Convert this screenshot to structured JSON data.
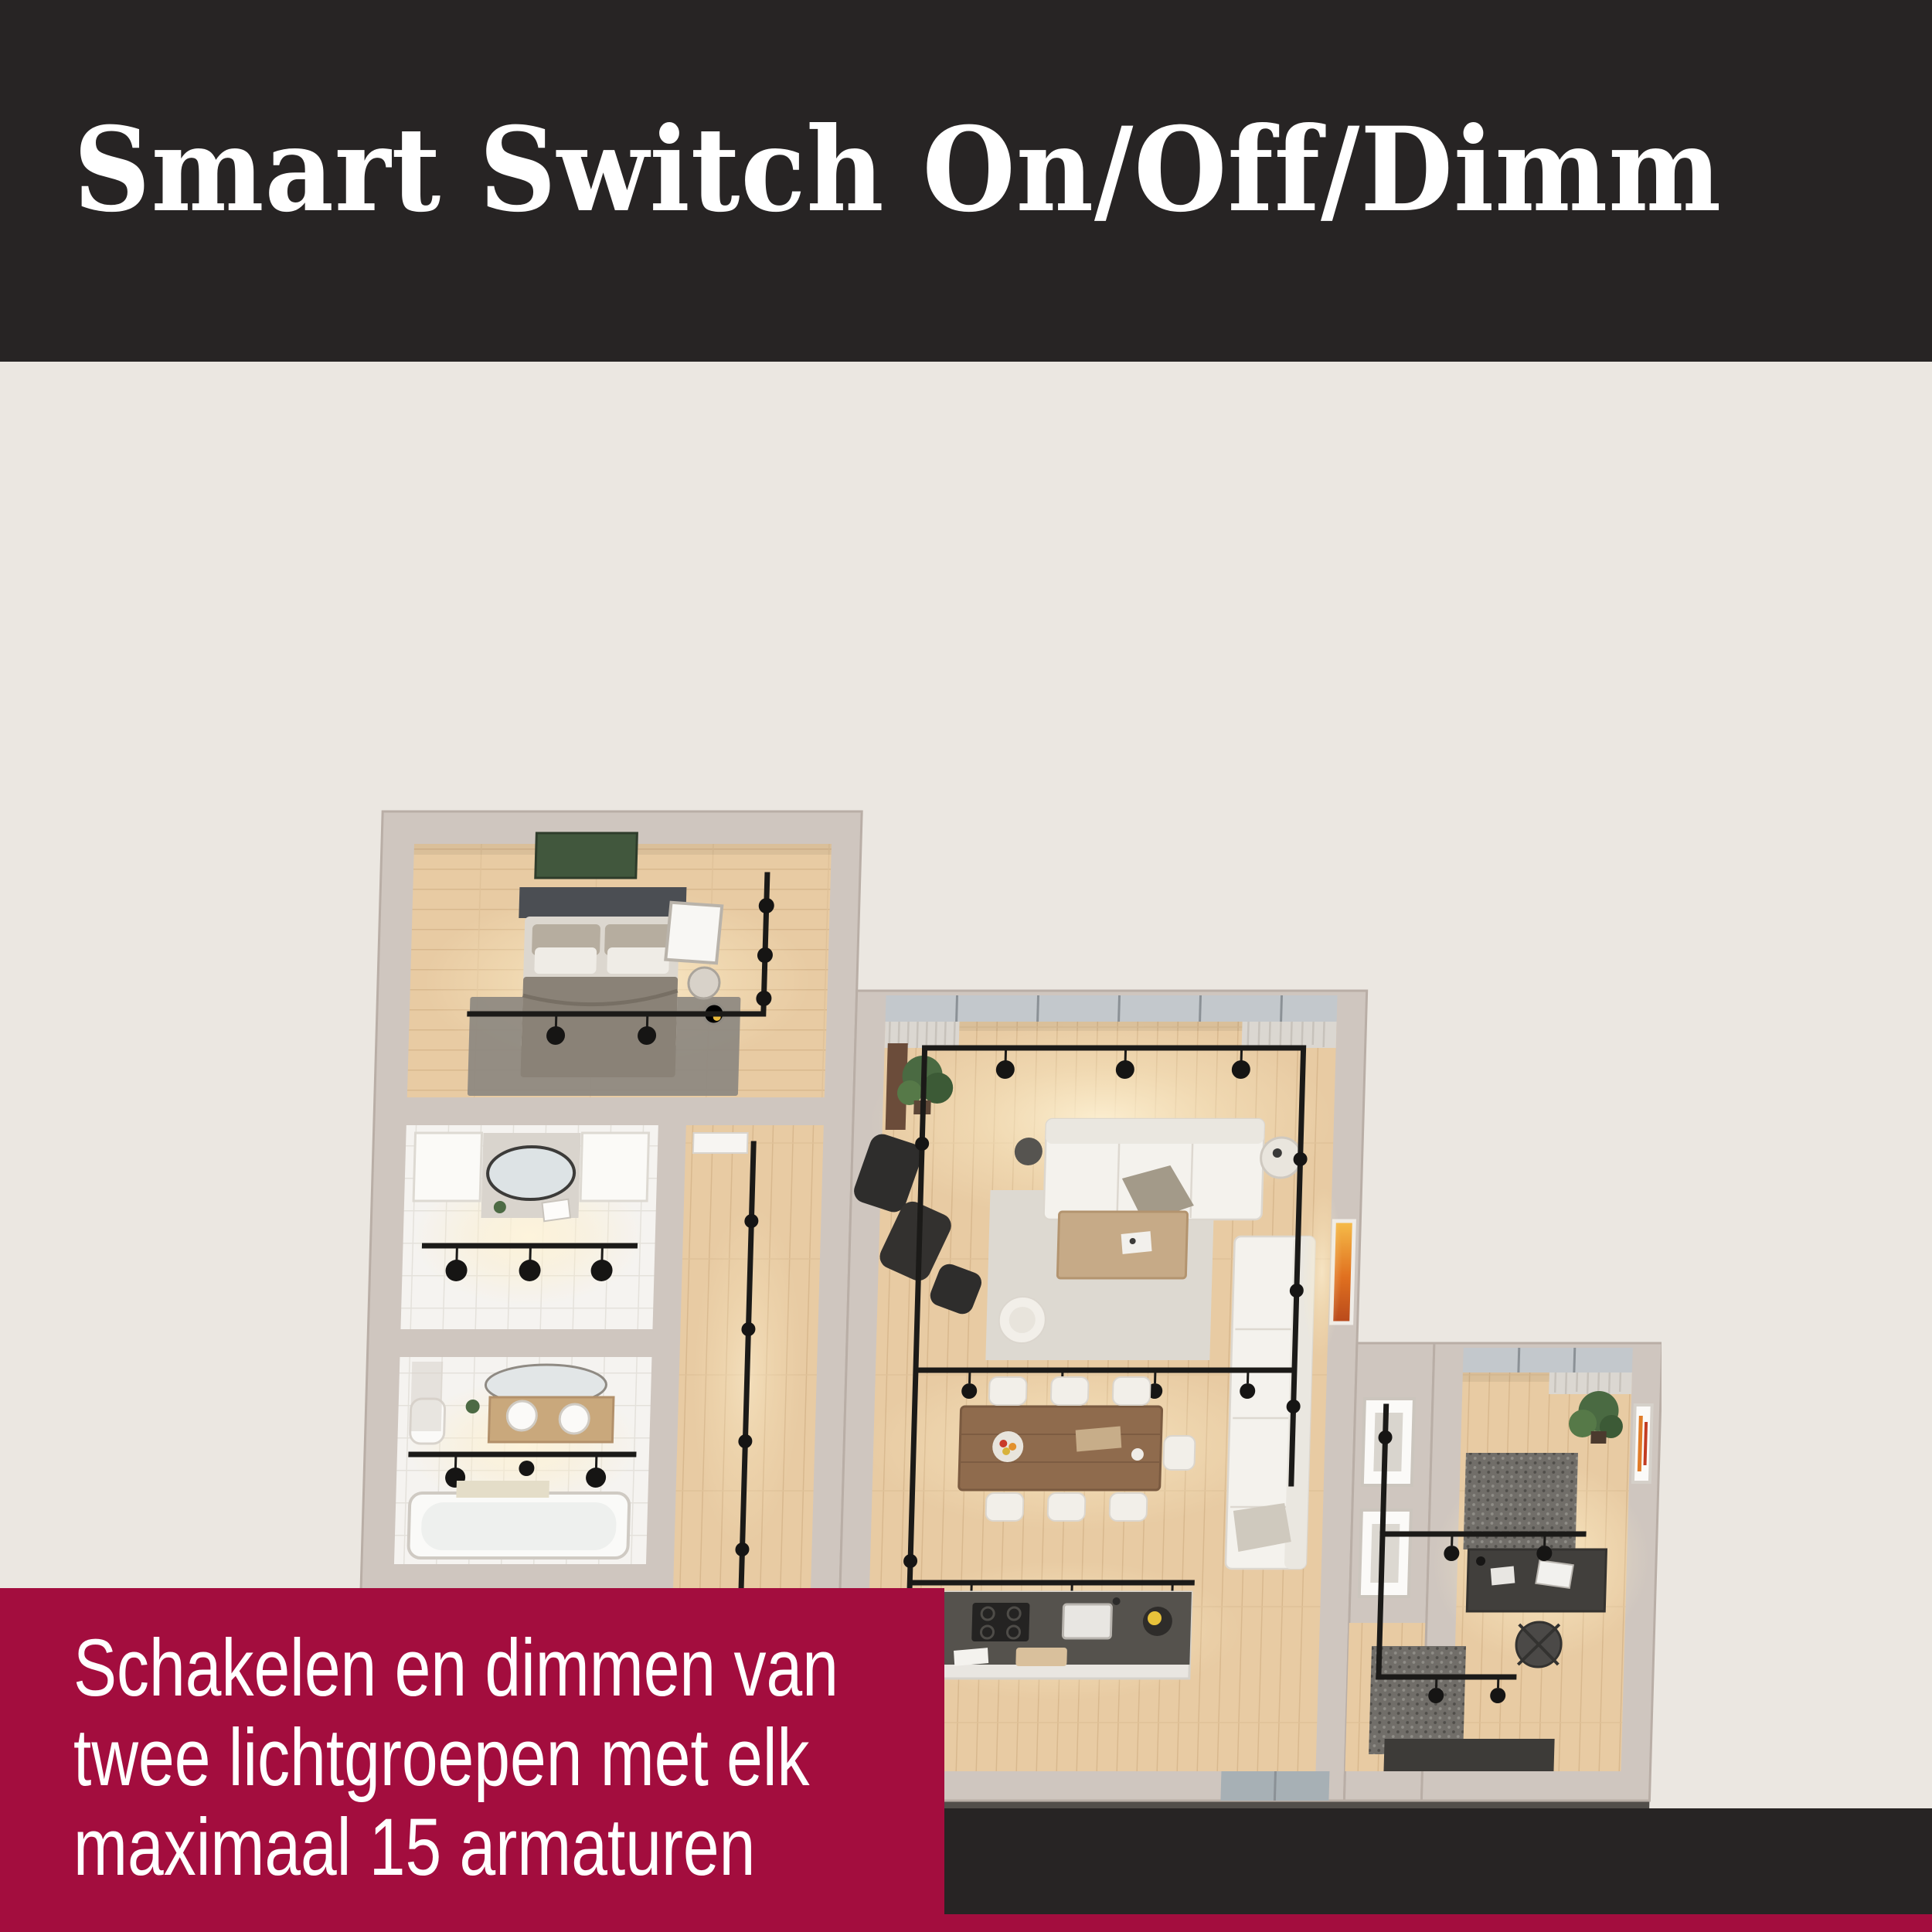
{
  "palette": {
    "bg": "#ebe7e1",
    "dark": "#272424",
    "red": "#a30d3e",
    "text-light": "#ffffff"
  },
  "header": {
    "title": "Smart Switch On/Off/Dimm"
  },
  "caption": {
    "lines": [
      "Schakelen en dimmen van",
      "twee lichtgroepen met elk",
      "maximaal 15 armaturen"
    ]
  },
  "floorplan": {
    "alt": "3D top-down rendering of an apartment with black track lighting in bedroom, two bathrooms, hallway, utility room, living and dining room, kitchen island and office",
    "palette": {
      "walls": "#cfc6bf",
      "wood_floor": "#e8cba3",
      "tile_floor": "#f5f3f0",
      "track": "#1b1a18",
      "base": "#56524e",
      "sofa": "#f4f2ed",
      "plant": "#4a6a42",
      "art_accent": "#e07b28"
    }
  }
}
